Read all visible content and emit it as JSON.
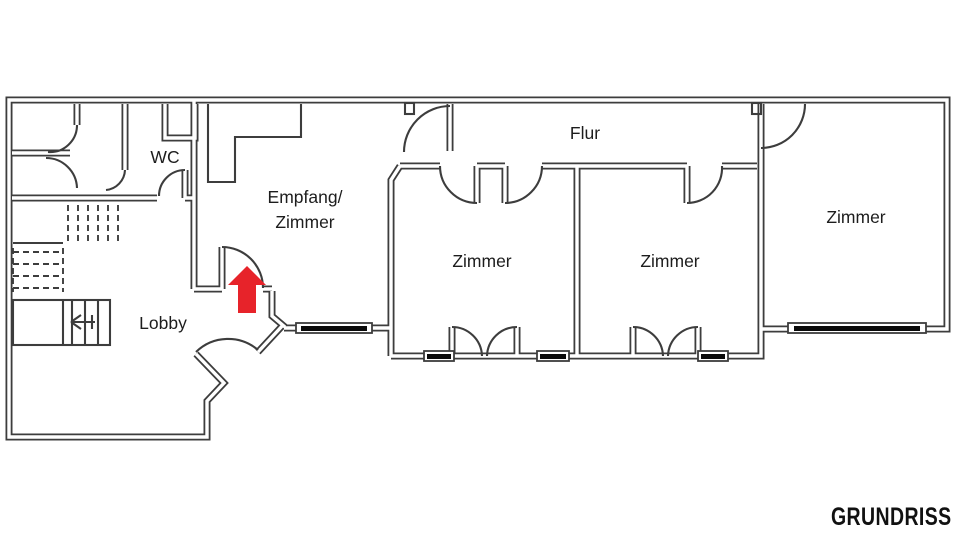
{
  "watermark": "GRUNDRISS",
  "colors": {
    "wall": "#3d3d3d",
    "text": "#1d1d1d",
    "arrow_red": "#e7232a",
    "background": "#ffffff",
    "window_glass": "#0a0a0a"
  },
  "rooms": {
    "wc": "WC",
    "empfang_line1": "Empfang/",
    "empfang_line2": "Zimmer",
    "flur": "Flur",
    "zimmer_left": "Zimmer",
    "zimmer_middle": "Zimmer",
    "zimmer_right": "Zimmer",
    "lobby": "Lobby"
  },
  "icons": {
    "entrance_arrow": "up-arrow",
    "stair_direction": "left-arrow"
  }
}
